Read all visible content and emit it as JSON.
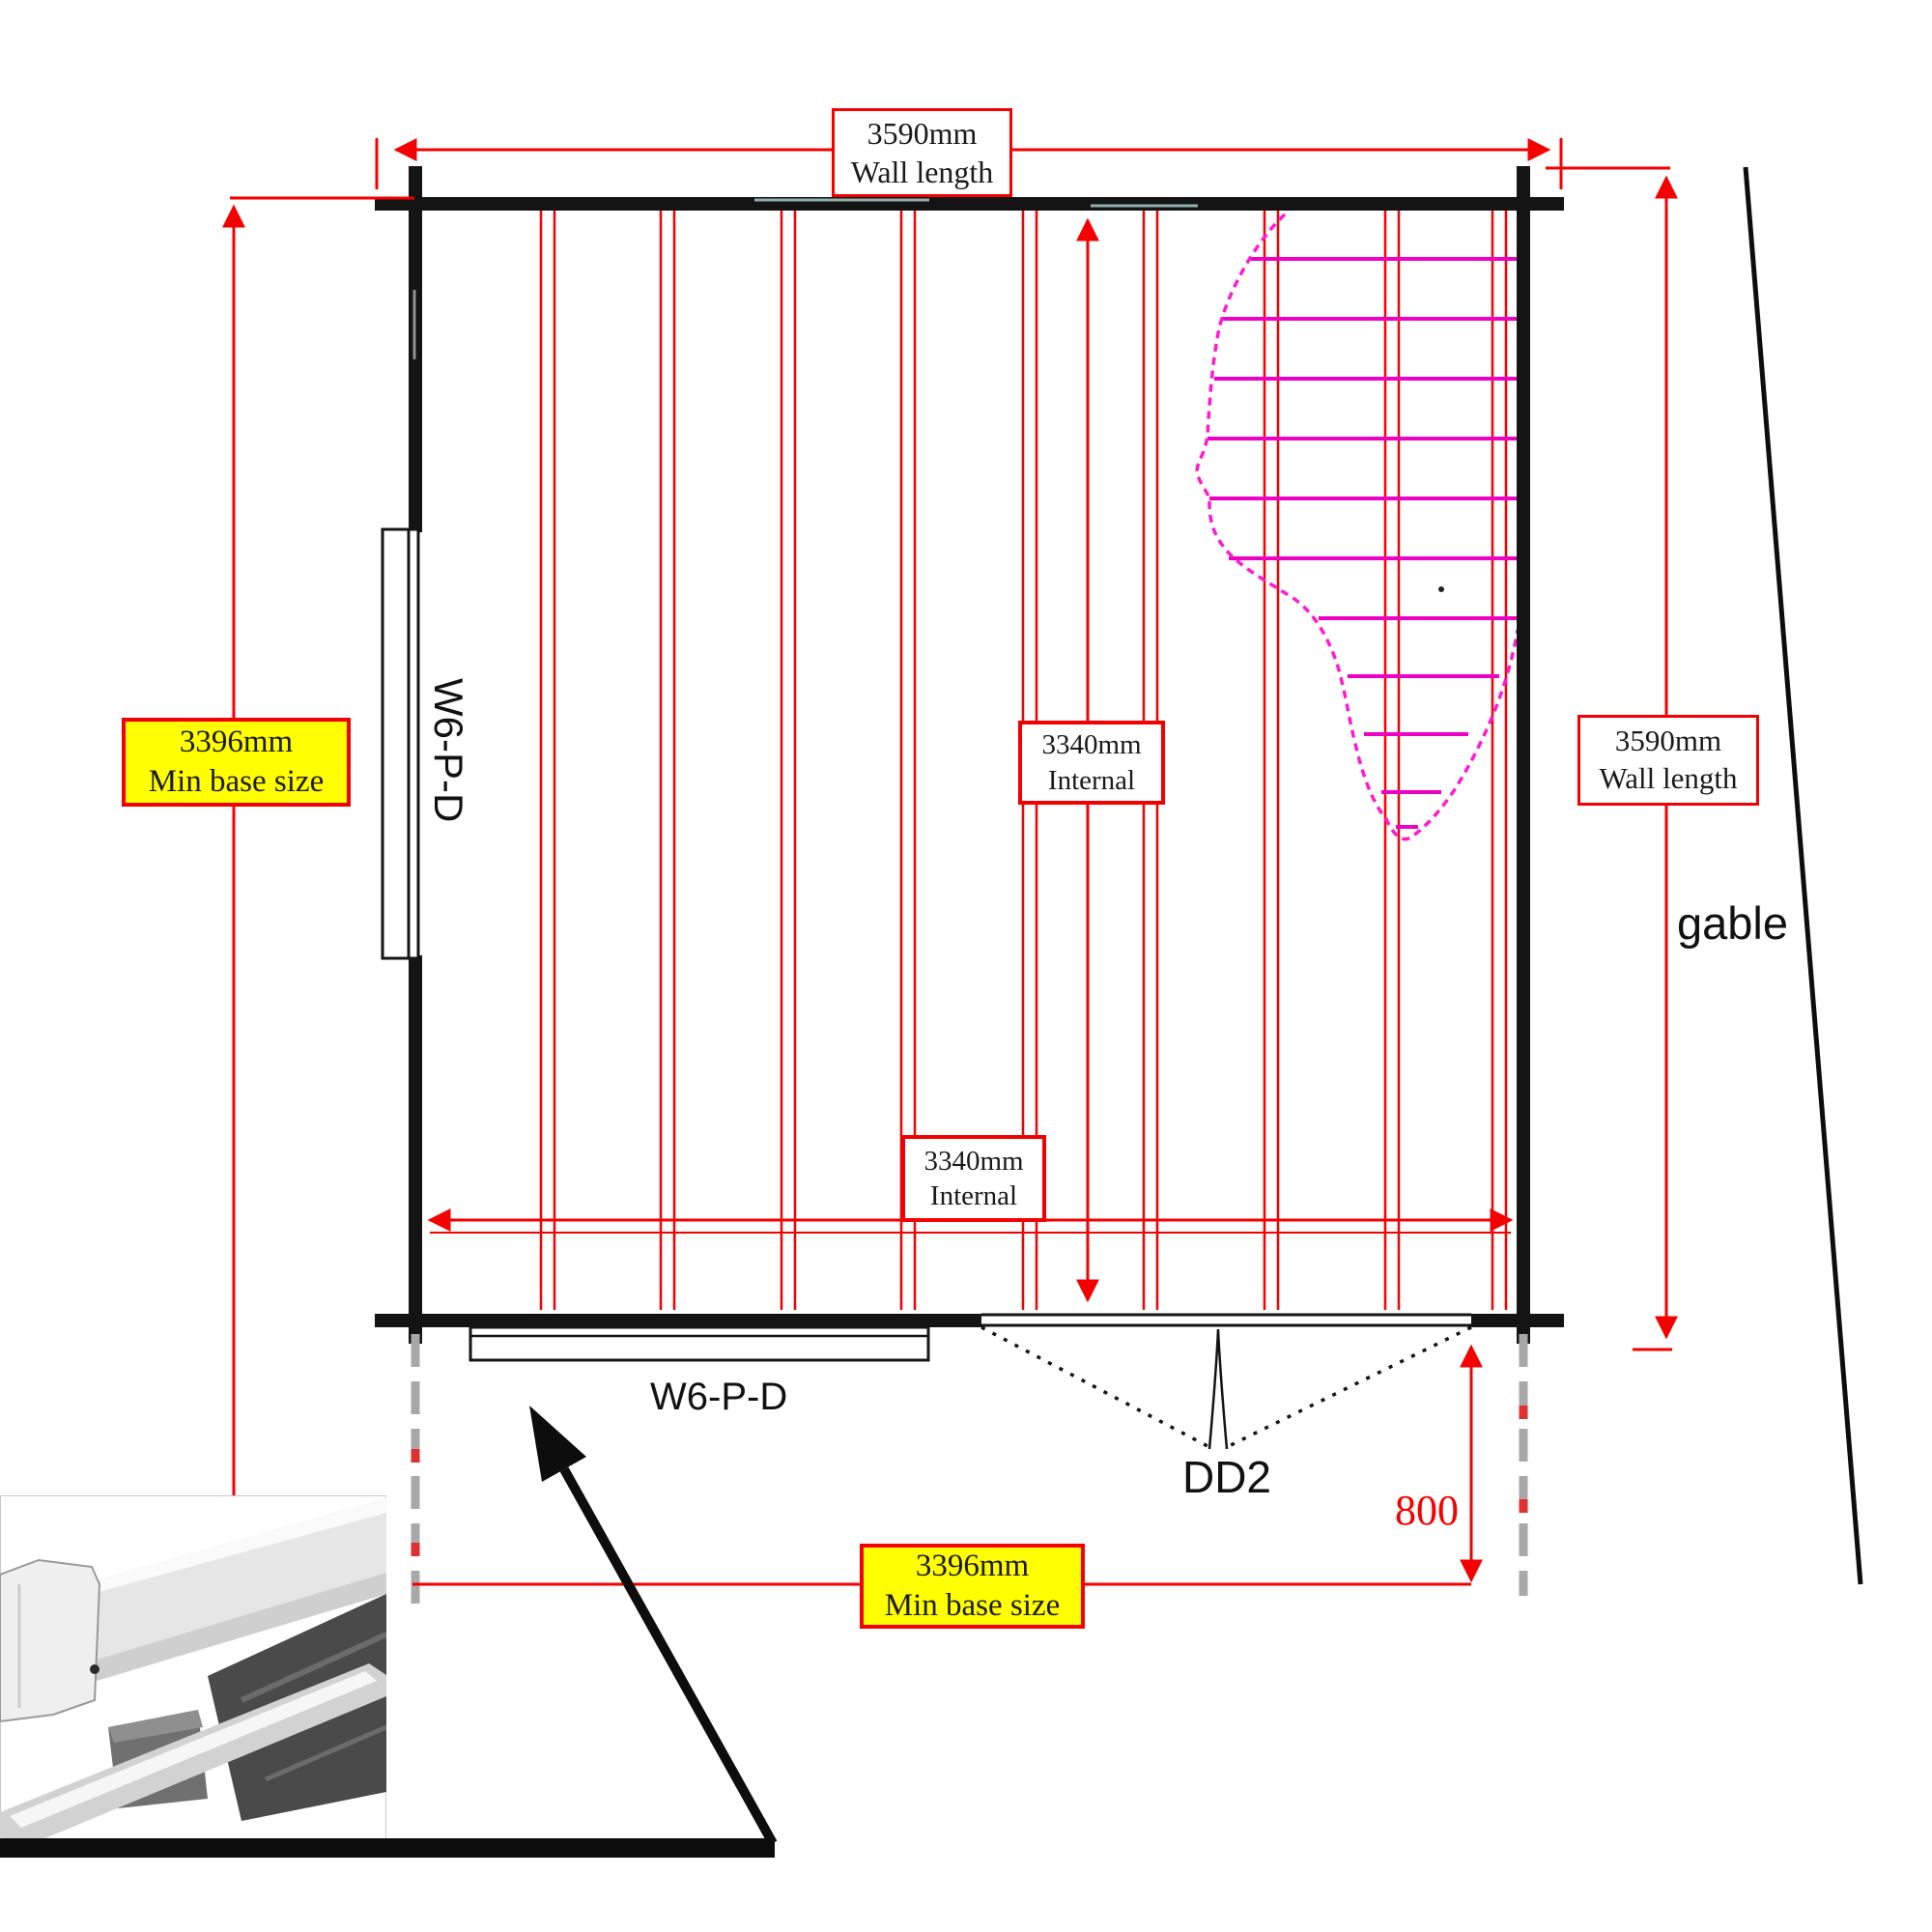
{
  "plan": {
    "dim_top": {
      "value": "3590mm",
      "label": "Wall length"
    },
    "dim_left": {
      "value": "3396mm",
      "label": "Min base size"
    },
    "dim_right": {
      "value": "3590mm",
      "label": "Wall length"
    },
    "dim_internal_v": {
      "value": "3340mm",
      "label": "Internal"
    },
    "dim_internal_h": {
      "value": "3340mm",
      "label": "Internal"
    },
    "dim_bottom": {
      "value": "3396mm",
      "label": "Min base size"
    },
    "dim_door_side": {
      "value": "800"
    },
    "gable_label": "gable",
    "window_left_label": "W6-P-D",
    "window_bottom_label": "W6-P-D",
    "door_label": "DD2"
  },
  "colors": {
    "dim": "#f40000",
    "wall": "#141414",
    "hatch": "#ee00c4",
    "hatch_edge": "#ff1ad1",
    "hl": "#ffff00"
  }
}
